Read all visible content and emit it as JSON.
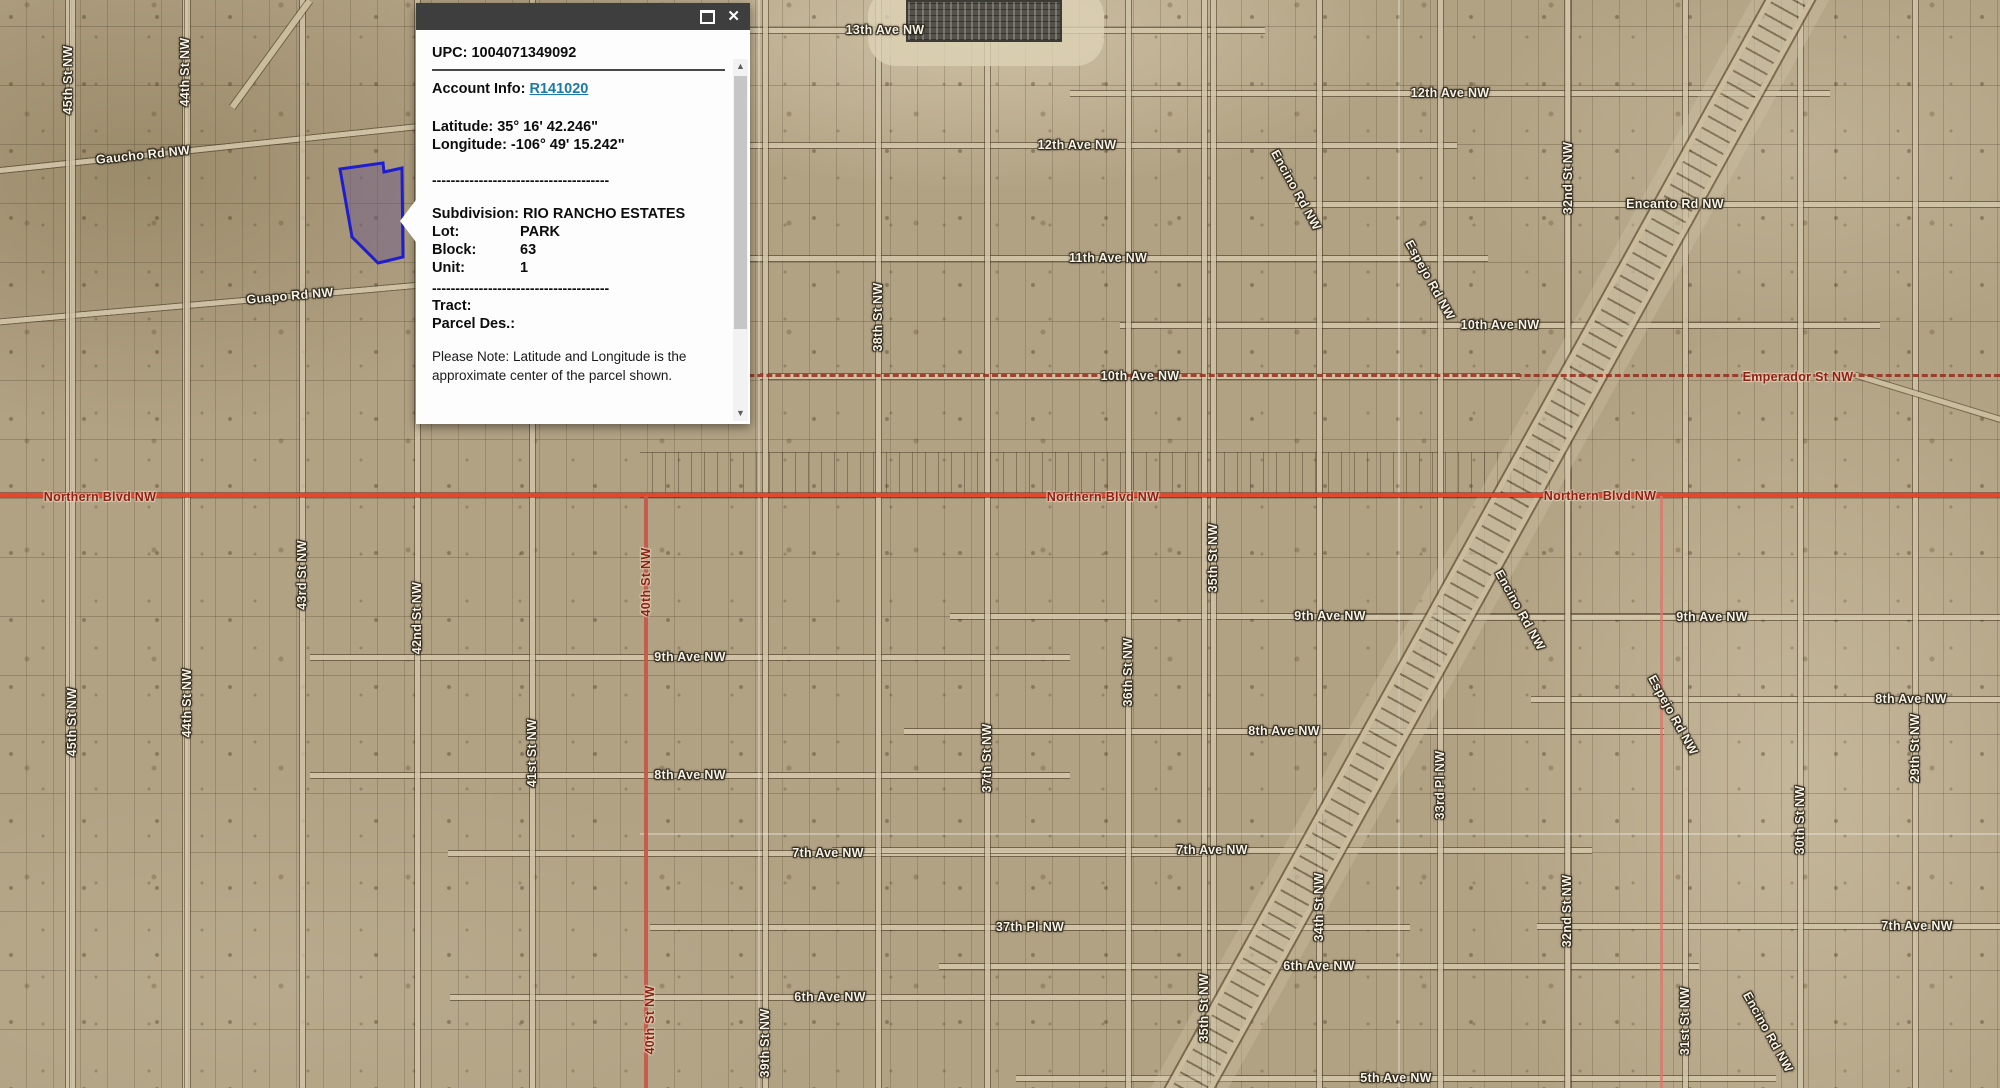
{
  "popup": {
    "upc": "UPC: 1004071349092",
    "account_label": "Account Info: ",
    "account_link": "R141020",
    "latitude": "Latitude: 35° 16' 42.246\"",
    "longitude": "Longitude: -106° 49' 15.242\"",
    "divider": "--------------------------------------",
    "subdivision": "Subdivision: RIO RANCHO ESTATES",
    "rows": [
      {
        "label": "Lot:",
        "value": "PARK"
      },
      {
        "label": "Block:",
        "value": "63"
      },
      {
        "label": "Unit:",
        "value": "1"
      }
    ],
    "tract_label": "Tract:",
    "parcel_des_label": "Parcel Des.:",
    "note": "Please Note: Latitude and Longitude is the approximate center of the parcel shown.",
    "icons": {
      "maximize": {
        "name": "maximize-icon"
      },
      "close": {
        "name": "close-icon",
        "glyph": "✕"
      },
      "scroll_up": {
        "name": "scroll-up-icon",
        "glyph": "▲"
      },
      "scroll_down": {
        "name": "scroll-down-icon",
        "glyph": "▼"
      }
    }
  },
  "colors": {
    "northern_blvd_line": "#e2482e",
    "survey_dashed_line": "#962b1b",
    "selected_parcel_outline": "#1e1ed0",
    "selected_parcel_fill": "rgba(110,90,135,0.5)",
    "account_link": "#1a7ba6",
    "road_label_white": "#f5f2e8",
    "road_label_maroon": "#8c2114"
  },
  "map": {
    "labels": [
      {
        "t": "13th Ave NW",
        "x": 885,
        "y": 30,
        "r": 0,
        "k": "w"
      },
      {
        "t": "12th Ave NW",
        "x": 1077,
        "y": 145,
        "r": 0,
        "k": "w"
      },
      {
        "t": "12th Ave NW",
        "x": 1450,
        "y": 93,
        "r": 0,
        "k": "w"
      },
      {
        "t": "11th Ave NW",
        "x": 1108,
        "y": 258,
        "r": 0,
        "k": "w"
      },
      {
        "t": "10th Ave NW",
        "x": 1140,
        "y": 376,
        "r": 0,
        "k": "w"
      },
      {
        "t": "10th Ave NW",
        "x": 1500,
        "y": 325,
        "r": 0,
        "k": "w"
      },
      {
        "t": "Encanto Rd NW",
        "x": 1675,
        "y": 204,
        "r": 0,
        "k": "w"
      },
      {
        "t": "Emperador St NW",
        "x": 1798,
        "y": 377,
        "r": 0,
        "k": "m"
      },
      {
        "t": "Gaucho Rd NW",
        "x": 143,
        "y": 155,
        "r": -6,
        "k": "w"
      },
      {
        "t": "Guapo Rd NW",
        "x": 290,
        "y": 296,
        "r": -5,
        "k": "w"
      },
      {
        "t": "Northern Blvd NW",
        "x": 100,
        "y": 497,
        "r": 0,
        "k": "m"
      },
      {
        "t": "Northern Blvd NW",
        "x": 1103,
        "y": 497,
        "r": 0,
        "k": "m"
      },
      {
        "t": "Northern Blvd NW",
        "x": 1600,
        "y": 496,
        "r": 0,
        "k": "m"
      },
      {
        "t": "9th Ave NW",
        "x": 690,
        "y": 657,
        "r": 0,
        "k": "w"
      },
      {
        "t": "9th Ave NW",
        "x": 1330,
        "y": 616,
        "r": 0,
        "k": "w"
      },
      {
        "t": "9th Ave NW",
        "x": 1712,
        "y": 617,
        "r": 0,
        "k": "w"
      },
      {
        "t": "8th Ave NW",
        "x": 690,
        "y": 775,
        "r": 0,
        "k": "w"
      },
      {
        "t": "8th Ave NW",
        "x": 1284,
        "y": 731,
        "r": 0,
        "k": "w"
      },
      {
        "t": "8th Ave NW",
        "x": 1911,
        "y": 699,
        "r": 0,
        "k": "w"
      },
      {
        "t": "7th Ave NW",
        "x": 828,
        "y": 853,
        "r": 0,
        "k": "w"
      },
      {
        "t": "7th Ave NW",
        "x": 1212,
        "y": 850,
        "r": 0,
        "k": "w"
      },
      {
        "t": "7th Ave NW",
        "x": 1917,
        "y": 926,
        "r": 0,
        "k": "w"
      },
      {
        "t": "6th Ave NW",
        "x": 830,
        "y": 997,
        "r": 0,
        "k": "w"
      },
      {
        "t": "6th Ave NW",
        "x": 1319,
        "y": 966,
        "r": 0,
        "k": "w"
      },
      {
        "t": "5th Ave NW",
        "x": 1396,
        "y": 1078,
        "r": 0,
        "k": "w"
      },
      {
        "t": "37th Pl NW",
        "x": 1030,
        "y": 927,
        "r": 0,
        "k": "w"
      },
      {
        "t": "45th St NW",
        "x": 68,
        "y": 80,
        "r": -90,
        "k": "w"
      },
      {
        "t": "44th St NW",
        "x": 185,
        "y": 72,
        "r": -90,
        "k": "w"
      },
      {
        "t": "45th St NW",
        "x": 72,
        "y": 722,
        "r": -90,
        "k": "w"
      },
      {
        "t": "44th St NW",
        "x": 187,
        "y": 703,
        "r": -90,
        "k": "w"
      },
      {
        "t": "43rd St NW",
        "x": 302,
        "y": 575,
        "r": -90,
        "k": "w"
      },
      {
        "t": "42nd St NW",
        "x": 417,
        "y": 618,
        "r": -90,
        "k": "w"
      },
      {
        "t": "41st St NW",
        "x": 532,
        "y": 753,
        "r": -90,
        "k": "w"
      },
      {
        "t": "40th St NW",
        "x": 646,
        "y": 582,
        "r": -90,
        "k": "m"
      },
      {
        "t": "40th St NW",
        "x": 650,
        "y": 1020,
        "r": -90,
        "k": "m"
      },
      {
        "t": "39th St NW",
        "x": 765,
        "y": 1043,
        "r": -90,
        "k": "w"
      },
      {
        "t": "38th St NW",
        "x": 878,
        "y": 317,
        "r": -90,
        "k": "w"
      },
      {
        "t": "37th St NW",
        "x": 987,
        "y": 758,
        "r": -90,
        "k": "w"
      },
      {
        "t": "36th St NW",
        "x": 1128,
        "y": 672,
        "r": -90,
        "k": "w"
      },
      {
        "t": "35th St NW",
        "x": 1213,
        "y": 558,
        "r": -90,
        "k": "w"
      },
      {
        "t": "35th St NW",
        "x": 1204,
        "y": 1008,
        "r": -90,
        "k": "w"
      },
      {
        "t": "34th St NW",
        "x": 1319,
        "y": 907,
        "r": -90,
        "k": "w"
      },
      {
        "t": "33rd Pl NW",
        "x": 1440,
        "y": 785,
        "r": -90,
        "k": "w"
      },
      {
        "t": "32nd St NW",
        "x": 1568,
        "y": 178,
        "r": -90,
        "k": "w"
      },
      {
        "t": "32nd St NW",
        "x": 1567,
        "y": 911,
        "r": -90,
        "k": "w"
      },
      {
        "t": "29th St NW",
        "x": 1915,
        "y": 748,
        "r": -90,
        "k": "w"
      },
      {
        "t": "30th St NW",
        "x": 1800,
        "y": 820,
        "r": -90,
        "k": "w"
      },
      {
        "t": "31st St NW",
        "x": 1685,
        "y": 1021,
        "r": -90,
        "k": "w"
      },
      {
        "t": "Encino Rd NW",
        "x": 1296,
        "y": 190,
        "r": 61,
        "k": "w"
      },
      {
        "t": "Espejo Rd NW",
        "x": 1430,
        "y": 280,
        "r": 61,
        "k": "w"
      },
      {
        "t": "Encino Rd NW",
        "x": 1520,
        "y": 610,
        "r": 61,
        "k": "w"
      },
      {
        "t": "Espejo Rd NW",
        "x": 1673,
        "y": 715,
        "r": 61,
        "k": "w"
      },
      {
        "t": "Encino Rd NW",
        "x": 1768,
        "y": 1032,
        "r": 61,
        "k": "w"
      }
    ]
  }
}
